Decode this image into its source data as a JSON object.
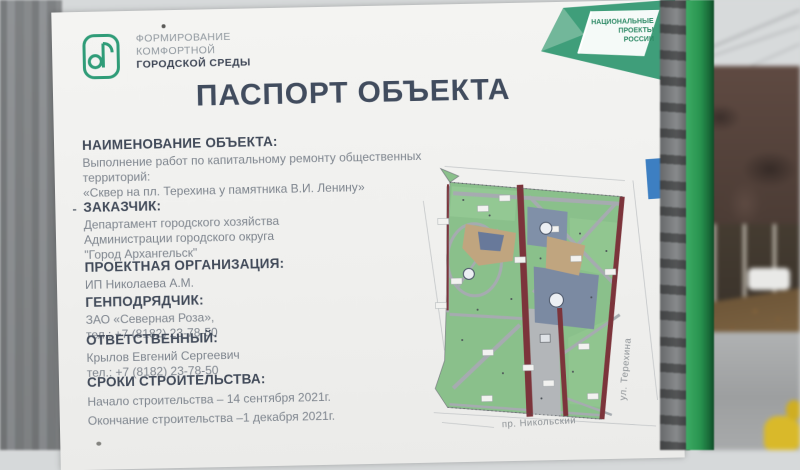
{
  "board": {
    "program_logo": {
      "line1": "ФОРМИРОВАНИЕ",
      "line2": "КОМФОРТНОЙ",
      "line3": "ГОРОДСКОЙ СРЕДЫ"
    },
    "national_projects_logo": {
      "line1": "НАЦИОНАЛЬНЫЕ",
      "line2": "ПРОЕКТЫ",
      "line3": "РОССИИ"
    },
    "title": "ПАСПОРТ ОБЪЕКТА",
    "sections": [
      {
        "heading": "НАИМЕНОВАНИЕ ОБЪЕКТА:",
        "lines": [
          "Выполнение работ по капитальному ремонту общественных территорий:",
          "«Сквер на пл. Терехина у памятника В.И. Ленину»"
        ]
      },
      {
        "prefix": "-",
        "heading": "ЗАКАЗЧИК:",
        "lines": [
          "Департамент городского хозяйства",
          "Администрации городского округа",
          "\"Город Архангельск\""
        ]
      },
      {
        "heading": "ПРОЕКТНАЯ ОРГАНИЗАЦИЯ:",
        "lines": [
          "ИП Николаева А.М."
        ]
      },
      {
        "heading": "ГЕНПОДРЯДЧИК:",
        "lines": [
          "ЗАО «Северная Роза»,",
          "тел.: +7 (8182) 23-78-50"
        ]
      },
      {
        "heading": "ОТВЕТСТВЕННЫЙ:",
        "lines": [
          "Крылов Евгений Сергеевич",
          "тел.: +7 (8182) 23-78-50"
        ]
      },
      {
        "heading": "СРОКИ СТРОИТЕЛЬСТВА:",
        "lines": [
          "Начало строительства – 14 сентября 2021г.",
          "Окончание строительства –1 декабря 2021г."
        ]
      }
    ],
    "map": {
      "street_right": "ул. Терехина",
      "street_bottom": "пр. Никольский"
    },
    "colors": {
      "brand_green": "#3f9e7a",
      "accent_blue": "#3d7fc2",
      "map_road_red": "#7c343b",
      "map_green": "#8ac08b",
      "fence_green": "#28934f",
      "title_text": "#414c5e"
    }
  }
}
